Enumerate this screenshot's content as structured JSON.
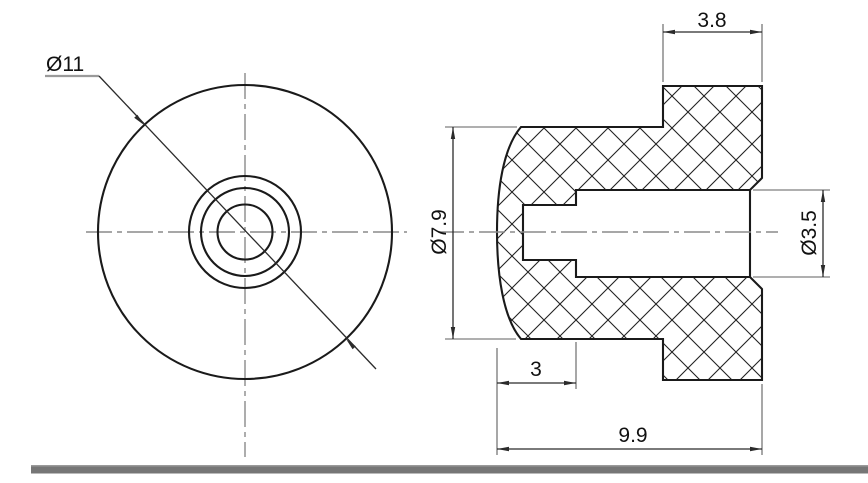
{
  "drawing": {
    "type": "engineering-cross-section",
    "part": "flanged bumper / grommet with stepped blind hole",
    "front_view": {
      "outer_diameter_label": "Ø11"
    },
    "section_view": {
      "flange_width_label": "3.8",
      "body_diameter_label": "Ø7.9",
      "hole_diameter_label": "Ø3.5",
      "hole_depth_label": "3",
      "overall_length_label": "9.9"
    },
    "colors": {
      "outline": "#1a1a1a",
      "hatch": "#222222",
      "centerline": "#8a8a8a",
      "dimension": "#2b2b2b",
      "extension": "#5f5f5f",
      "underline": "#9a9a9a",
      "bottom_bar": "#767676",
      "bottom_bar_highlight": "#9a9a9a",
      "background": "#ffffff"
    }
  }
}
